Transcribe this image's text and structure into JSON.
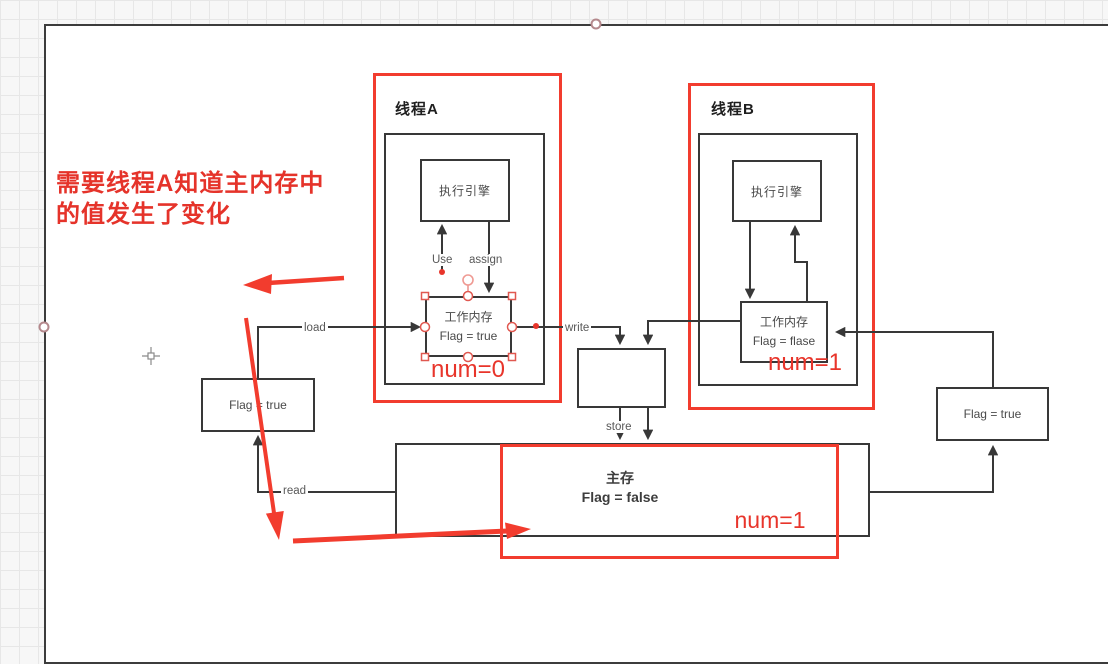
{
  "annotation": {
    "note_line1": "需要线程A知道主内存中",
    "note_line2": "的值发生了变化"
  },
  "thread_a": {
    "title": "线程A",
    "engine_label": "执行引擎",
    "working_memory_title": "工作内存",
    "working_memory_flag": "Flag = true",
    "num_label": "num=0"
  },
  "thread_b": {
    "title": "线程B",
    "engine_label": "执行引擎",
    "working_memory_title": "工作内存",
    "working_memory_flag": "Flag = flase",
    "num_label": "num=1"
  },
  "edge_labels": {
    "use": "Use",
    "assign": "assign",
    "load": "load",
    "write": "write",
    "store": "store",
    "read": "read"
  },
  "left_flag_box": {
    "label": "Flag = true"
  },
  "right_flag_box": {
    "label": "Flag = true"
  },
  "main_memory": {
    "title": "主存",
    "flag_label": "Flag = false",
    "num_label": "num=1"
  },
  "colors": {
    "highlight_red": "#f23c2e",
    "text_red": "#e8352b",
    "line_dark": "#383838"
  }
}
